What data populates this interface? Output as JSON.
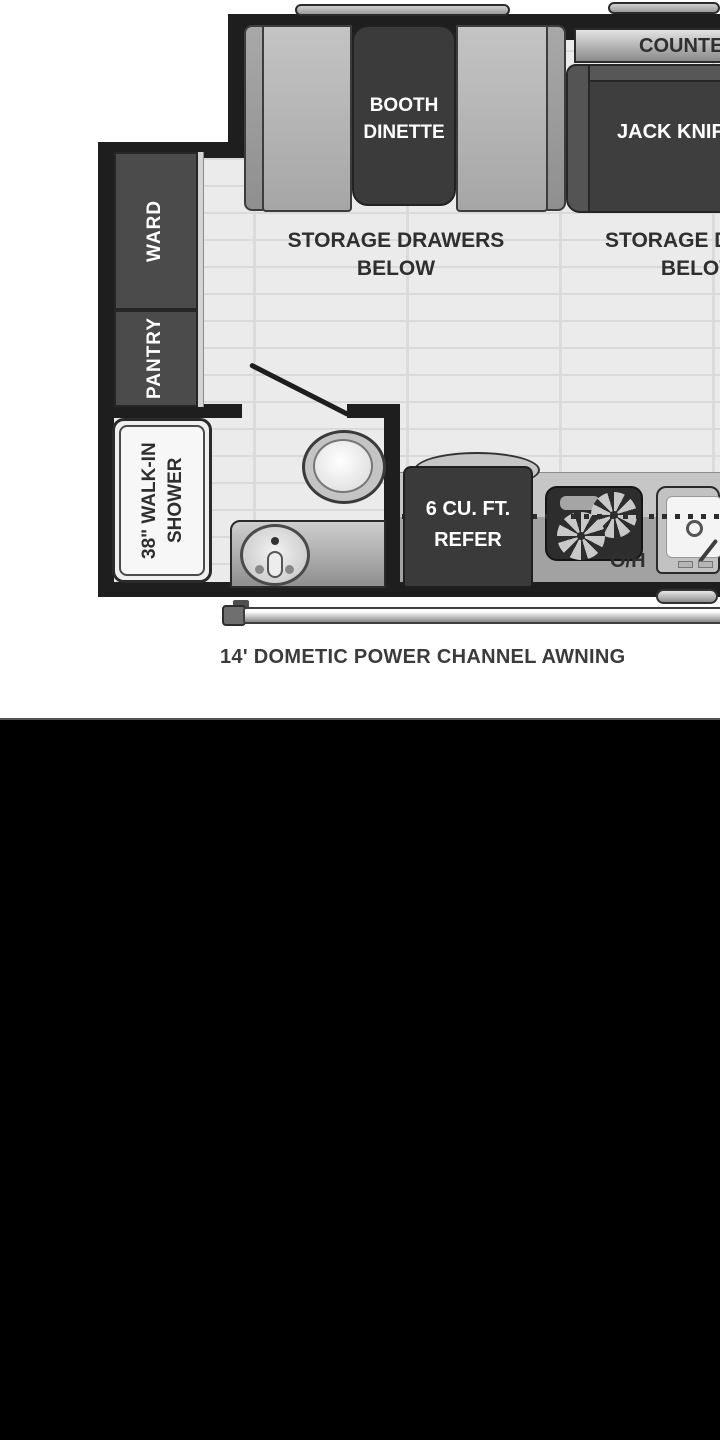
{
  "floorplan": {
    "dinette": {
      "table_line1": "BOOTH",
      "table_line2": "DINETTE"
    },
    "storage_left": {
      "line1": "STORAGE DRAWERS",
      "line2": "BELOW"
    },
    "storage_right": {
      "line1": "STORAGE DRAWERS",
      "line2": "BELOW"
    },
    "counter_label": "COUNTERTOP",
    "sofa_label": "JACK KNIFE SOFA",
    "ward_label": "WARD",
    "pantry_label": "PANTRY",
    "shower": {
      "line1": "38\" WALK-IN",
      "line2": "SHOWER"
    },
    "refrigerator": {
      "line1": "6 CU. FT.",
      "line2": "REFER"
    },
    "overhead_label": "O/H",
    "awning_label": "14' DOMETIC POWER CHANNEL AWNING"
  },
  "colors": {
    "wall": "#1e1e1e",
    "cabinet_dark": "#4b4b4b",
    "furniture_dark": "#3b3b3b",
    "cushion_gray": "#b4b4b4",
    "floor_gray": "#ebebeb",
    "counter_gray": "#a2a2a2",
    "label_dark": "#2f2f2f",
    "label_white": "#ffffff",
    "bottom_panel": "#000000"
  }
}
